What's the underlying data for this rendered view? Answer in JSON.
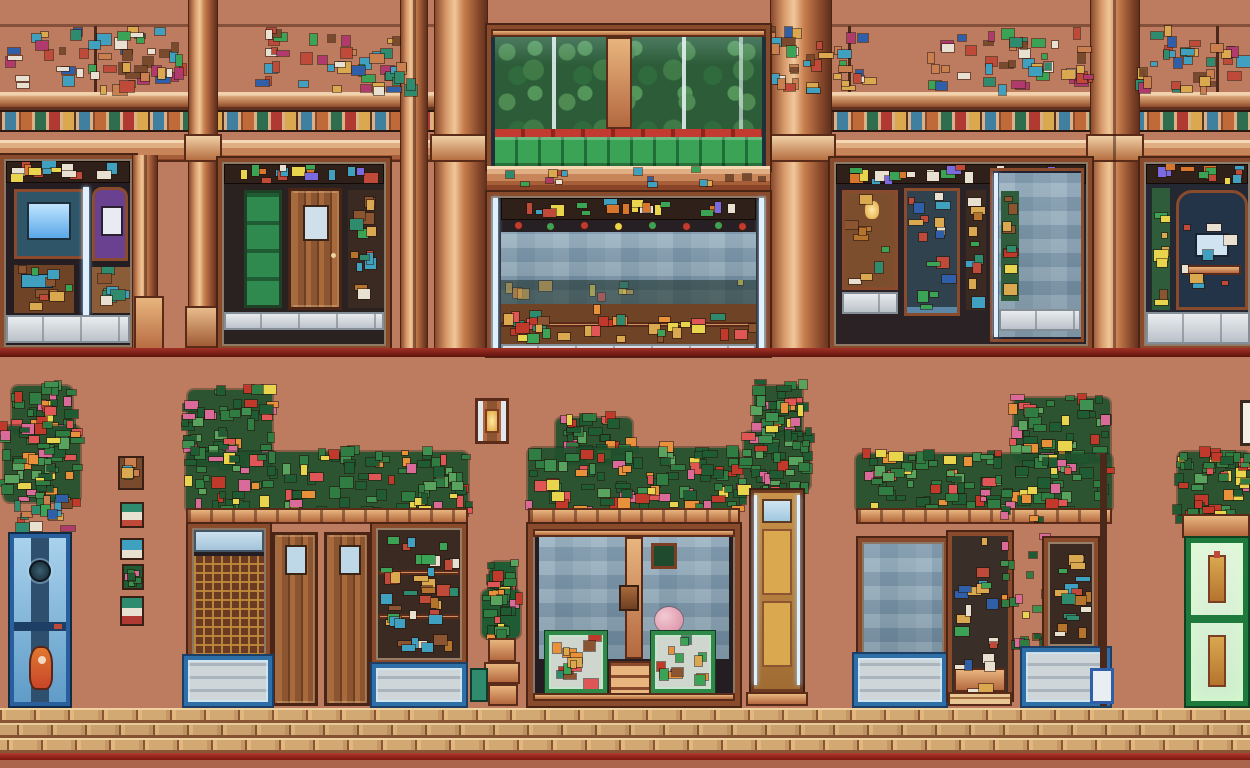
{
  "scene": {
    "type": "16-bit pixel-art building facade tileset",
    "rows": 2,
    "upper_storefront_count": 5,
    "lower_shop_count": 3,
    "display_case_count": 3,
    "visible_text": ""
  },
  "palette": {
    "wall": "#bd7c60",
    "wallLower": "#aa654c",
    "outline": "#4a2414",
    "copper": "#b4683f",
    "copperLight": "#e9bd92",
    "copperDark": "#7c3e22",
    "ledgeHi": "#f2d2ac",
    "signband": "#30201a",
    "railRed": "#c23a30",
    "boxGreen": "#3aa355",
    "boxGreenDark": "#1f6e38",
    "glassBlue": "#8fa9ba",
    "glassLight": "#cfe0ea",
    "blueFrame": "#2e6fa8",
    "blueDeep": "#1d3f66",
    "caseGlassBlue": "#a9d2ec",
    "greenFrame": "#1e7a3c",
    "caseGlassGreen": "#cdeccd",
    "amber": "#d9a84f",
    "brick": "#d2a873",
    "brickJoint": "#845232",
    "redline": "#93261d",
    "treeGreen": "#2c5c38"
  },
  "pixel_palettes": {
    "clutter": [
      "#2e8b6e",
      "#3fa0c0",
      "#c04a3a",
      "#d9a84f",
      "#e8e0d0",
      "#7a4a2c",
      "#3aa355",
      "#b03a6e",
      "#2f5fa8",
      "#c97f4e"
    ],
    "flowers": [
      "#2f7d43",
      "#1f5c33",
      "#3e9150",
      "#2f7d43",
      "#58a35e",
      "#1f5c33",
      "#c0392b",
      "#e05656",
      "#d96a9a",
      "#e8913a",
      "#e8d44d",
      "#2f7d43",
      "#1f5c33"
    ],
    "signage": [
      "#3fa0c0",
      "#c04a3a",
      "#e8d44d",
      "#3aa355",
      "#e8e0d0",
      "#d9762e",
      "#7a6ae0"
    ],
    "produce": [
      "#e8913a",
      "#c0392b",
      "#3aa355",
      "#d9a84f",
      "#e05656",
      "#8a5530",
      "#e8d44d",
      "#2e8b6e"
    ],
    "goods": [
      "#d9a84f",
      "#b5742e",
      "#3aa355",
      "#3fa0c0",
      "#c04a3a",
      "#e8e0d0",
      "#8a5530",
      "#2e8b6e"
    ],
    "doorstuff": [
      "#3fa0c0",
      "#3aa355",
      "#d9a84f",
      "#c04a3a",
      "#e8e0d0",
      "#2f5fa8"
    ]
  },
  "objects": {
    "arcade_storefront": {
      "label": "upper storefront with screen displays",
      "colors": [
        "#8a4a2c",
        "#5aa7e8"
      ]
    },
    "general_storefront": {
      "label": "upper storefront with door and shelves",
      "colors": [
        "#8a4a2c",
        "#2f8a4f"
      ]
    },
    "balcony_window": {
      "label": "tall balcony window with trees and green planter boxes",
      "colors": [
        "#2c5c38",
        "#3aa355",
        "#c23a30"
      ]
    },
    "market_storefront": {
      "label": "central market storefront with produce shelves",
      "colors": [
        "#8a4a2c",
        "#8fa9ba"
      ]
    },
    "boutique_storefront": {
      "label": "upper storefront with door and tall blue window",
      "colors": [
        "#8a4a2c",
        "#7b97ab"
      ]
    },
    "office_storefront": {
      "label": "upper storefront with arched interior",
      "colors": [
        "#8a4a2c",
        "#243448"
      ]
    },
    "shelf_clutter": {
      "label": "second-floor shelf with knick-knacks",
      "colors": [
        "#2e8b6e",
        "#c04a3a"
      ]
    },
    "picture_frieze": {
      "label": "band of small framed pictures",
      "colors": [
        "#3f2418"
      ]
    },
    "flower_clock_tower": {
      "label": "flower-topped blue display case with clock and gnome",
      "colors": [
        "#2e6fa8",
        "#a9d2ec",
        "#e07830"
      ]
    },
    "wall_signs": {
      "label": "small wall-mounted signs and planters",
      "colors": [
        "#3fa0c0",
        "#c04a3a"
      ]
    },
    "flower_shop": {
      "label": "street shop with wine-rack window and double doors",
      "colors": [
        "#8a4a2c",
        "#2f7d43"
      ]
    },
    "wall_lamp": {
      "label": "copper wall lantern",
      "colors": [
        "#d9a84f"
      ]
    },
    "topiary": {
      "label": "potted topiary tree",
      "colors": [
        "#2f7d43",
        "#b4683f"
      ]
    },
    "cafe_storefront": {
      "label": "street cafe storefront with planter crates",
      "colors": [
        "#8a4a2c",
        "#2f8a4a",
        "#d98aa0"
      ]
    },
    "vine_cabinet": {
      "label": "flower-topped amber cabinet column",
      "colors": [
        "#b5813f",
        "#d9a84f"
      ]
    },
    "boutique_shop": {
      "label": "street shop with door, vine and benches",
      "colors": [
        "#8a4a2c",
        "#2e6fa8"
      ]
    },
    "green_display_case": {
      "label": "flower-topped green display case with bottles",
      "colors": [
        "#1e7a3c",
        "#cdeccd",
        "#d9a84f"
      ]
    },
    "cut_sign": {
      "label": "white sign at right edge",
      "colors": [
        "#f3efe6"
      ]
    },
    "sidewalk": {
      "label": "tan brick sidewalk with red curb line",
      "colors": [
        "#d2a873",
        "#93261d"
      ]
    }
  }
}
